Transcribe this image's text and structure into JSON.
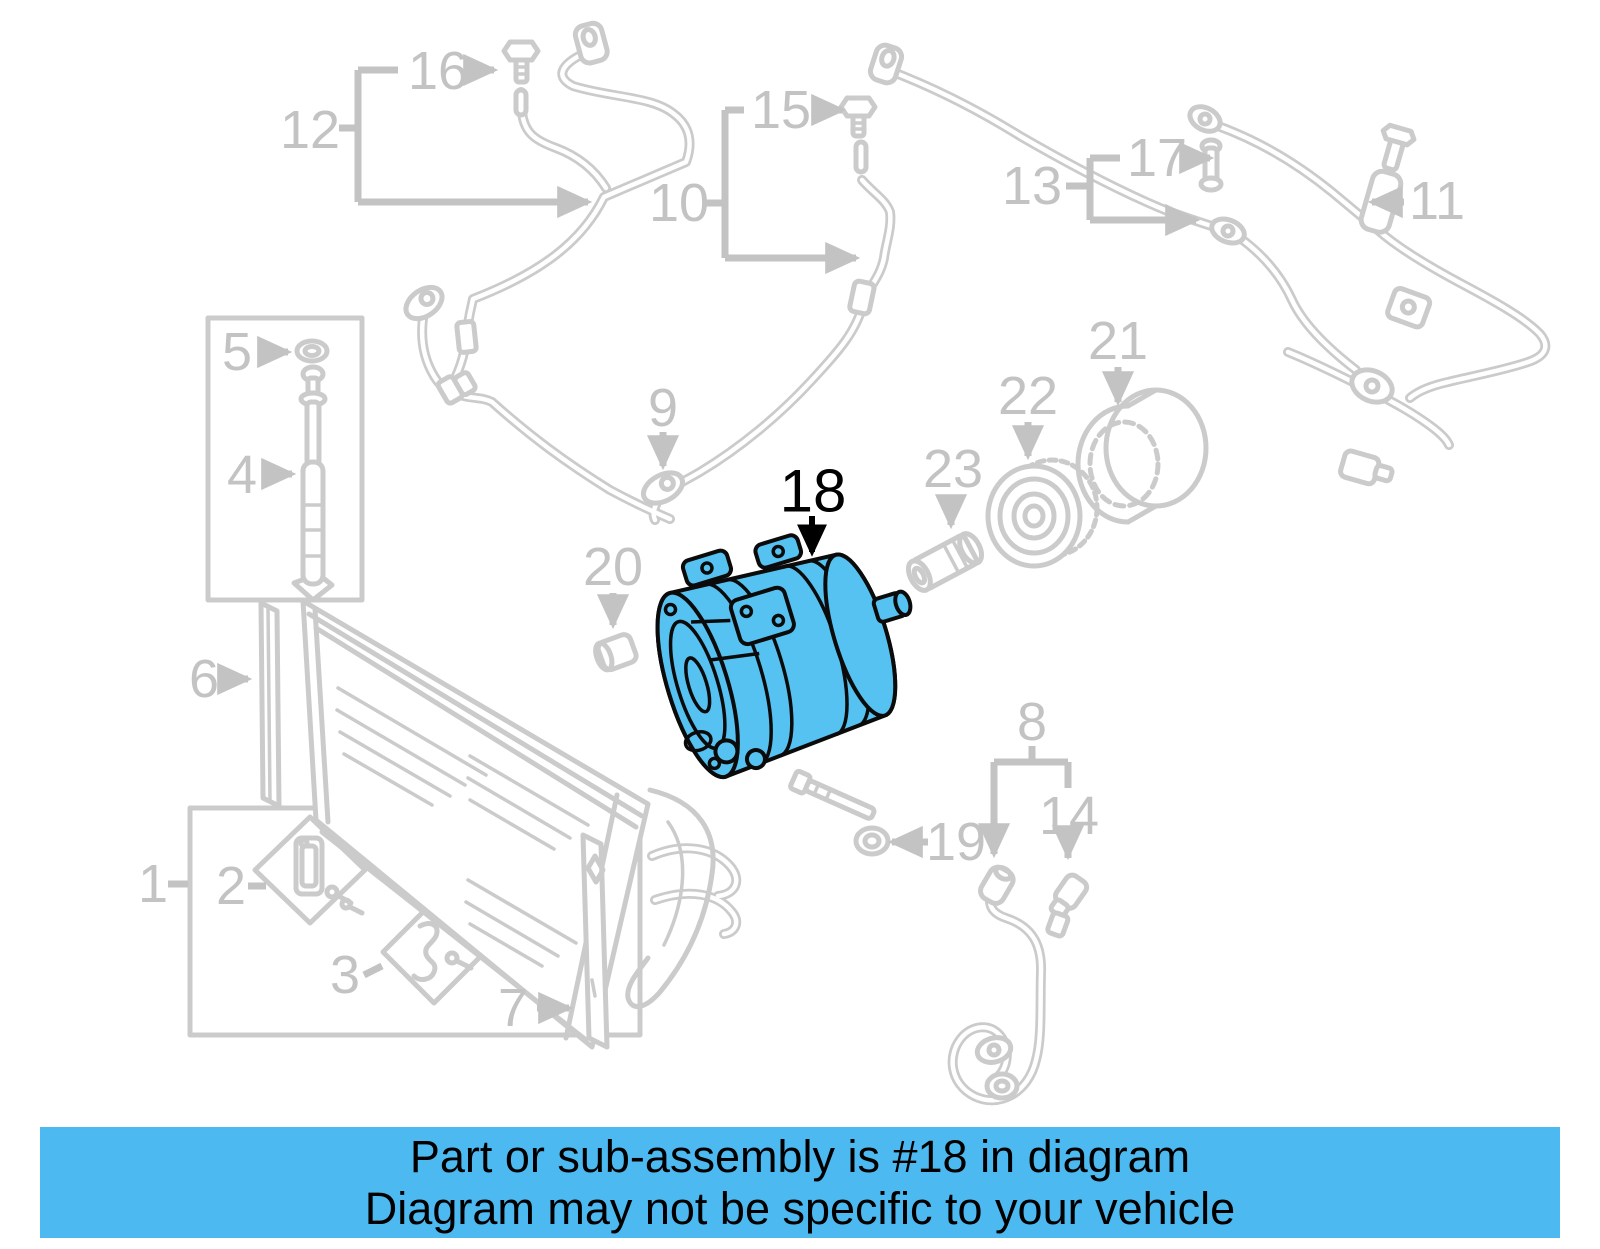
{
  "banner": {
    "line1": "Part or sub-assembly is #18 in diagram",
    "line2": "Diagram may not be specific to your vehicle",
    "background": "#4DB9F1",
    "text_color": "#000000"
  },
  "diagram": {
    "type": "exploded-parts-diagram",
    "subject": "A/C compressor and condenser assembly",
    "background": "#FFFFFF",
    "line_gray": "#CBCBCB",
    "label_gray": "#C3C3C3",
    "highlight_fill": "#56C2F1",
    "highlight_outline": "#0B0B0B",
    "highlighted_part": "18",
    "callouts": {
      "c1": {
        "label": "1"
      },
      "c2": {
        "label": "2"
      },
      "c3": {
        "label": "3"
      },
      "c4": {
        "label": "4"
      },
      "c5": {
        "label": "5"
      },
      "c6": {
        "label": "6"
      },
      "c7": {
        "label": "7"
      },
      "c8": {
        "label": "8"
      },
      "c9": {
        "label": "9"
      },
      "c10": {
        "label": "10"
      },
      "c11": {
        "label": "11"
      },
      "c12": {
        "label": "12"
      },
      "c13": {
        "label": "13"
      },
      "c14": {
        "label": "14"
      },
      "c15": {
        "label": "15"
      },
      "c16": {
        "label": "16"
      },
      "c17": {
        "label": "17"
      },
      "c18": {
        "label": "18"
      },
      "c19": {
        "label": "19"
      },
      "c20": {
        "label": "20"
      },
      "c21": {
        "label": "21"
      },
      "c22": {
        "label": "22"
      },
      "c23": {
        "label": "23"
      }
    }
  }
}
